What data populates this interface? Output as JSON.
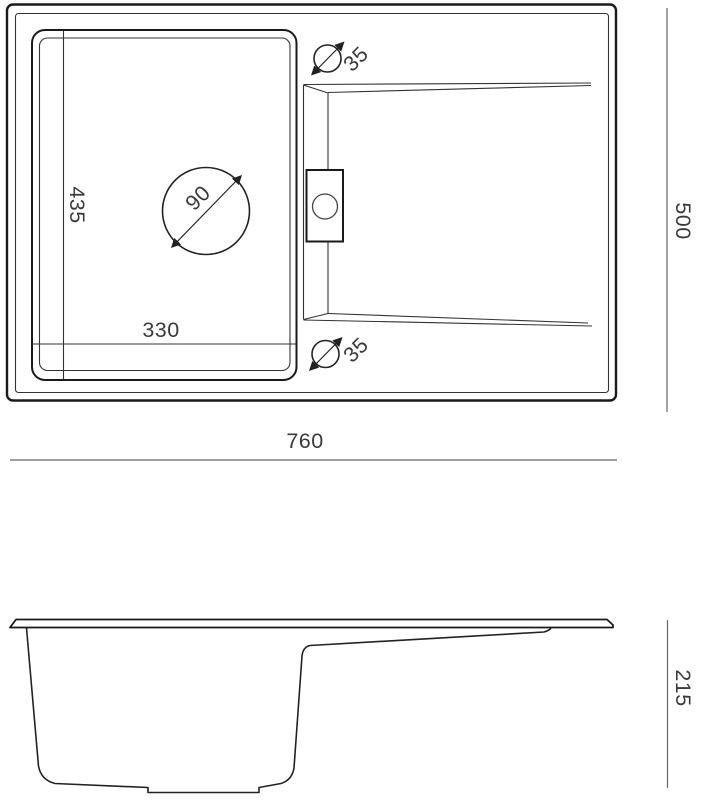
{
  "drawing_title": "kitchen-sink-technical-drawing",
  "labels": {
    "top_view": {
      "overall_width": "760",
      "overall_depth": "500",
      "bowl_depth": "435",
      "bowl_width": "330",
      "drain_diameter": "90",
      "tap_hole_top": "35",
      "tap_hole_bottom": "35"
    },
    "side_view": {
      "height": "215"
    }
  },
  "colors": {
    "outline": "#1a1a1a",
    "detail": "#333333",
    "dimension_line": "#666666",
    "text": "#3a3a3a",
    "background": "#ffffff"
  }
}
